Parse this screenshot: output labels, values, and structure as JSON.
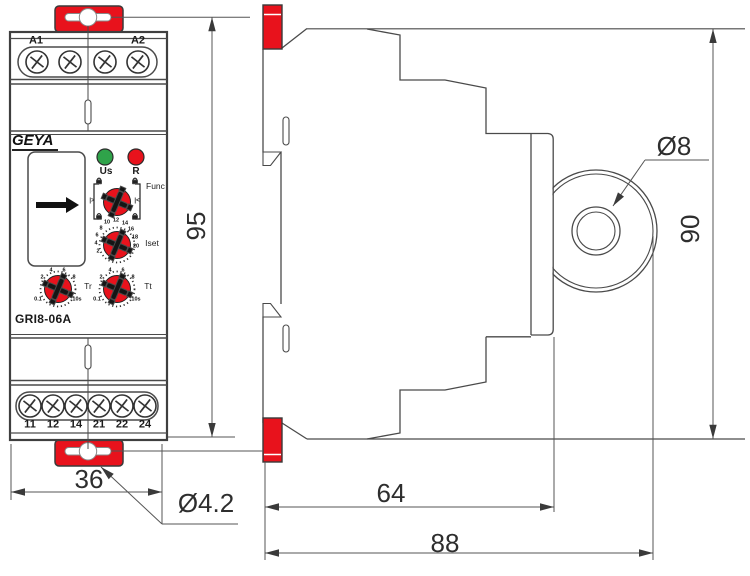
{
  "device": {
    "brand": "GEYA",
    "model": "GRI8-06A",
    "top_terminal_labels": [
      "A1",
      "A2"
    ],
    "bottom_terminal_labels": [
      "11",
      "12",
      "14",
      "21",
      "22",
      "24"
    ],
    "leds": {
      "power_label": "Us",
      "relay_label": "R"
    },
    "knobs": {
      "func": {
        "label": "Func",
        "left_mark": "|>",
        "right_mark": "|<"
      },
      "iset": {
        "label": "Iset",
        "scale": [
          "2",
          "4",
          "6",
          "8",
          "10",
          "12",
          "14",
          "16",
          "18",
          "20"
        ]
      },
      "tr": {
        "label": "Tr",
        "scale": [
          "0.1",
          "2",
          "4",
          "6",
          "8",
          "10s"
        ]
      },
      "tt": {
        "label": "Tt",
        "scale": [
          "0.1",
          "2",
          "4",
          "6",
          "8",
          "10s"
        ]
      }
    }
  },
  "dimensions": {
    "front_height": "95",
    "front_width": "36",
    "front_hole": "Ø4.2",
    "side_depth_din": "64",
    "side_depth_total": "88",
    "side_height": "90",
    "side_hole": "Ø8"
  },
  "colors": {
    "accent_red": "#e8121c",
    "led_green": "#2fa34a",
    "line": "#4a4a4a"
  }
}
